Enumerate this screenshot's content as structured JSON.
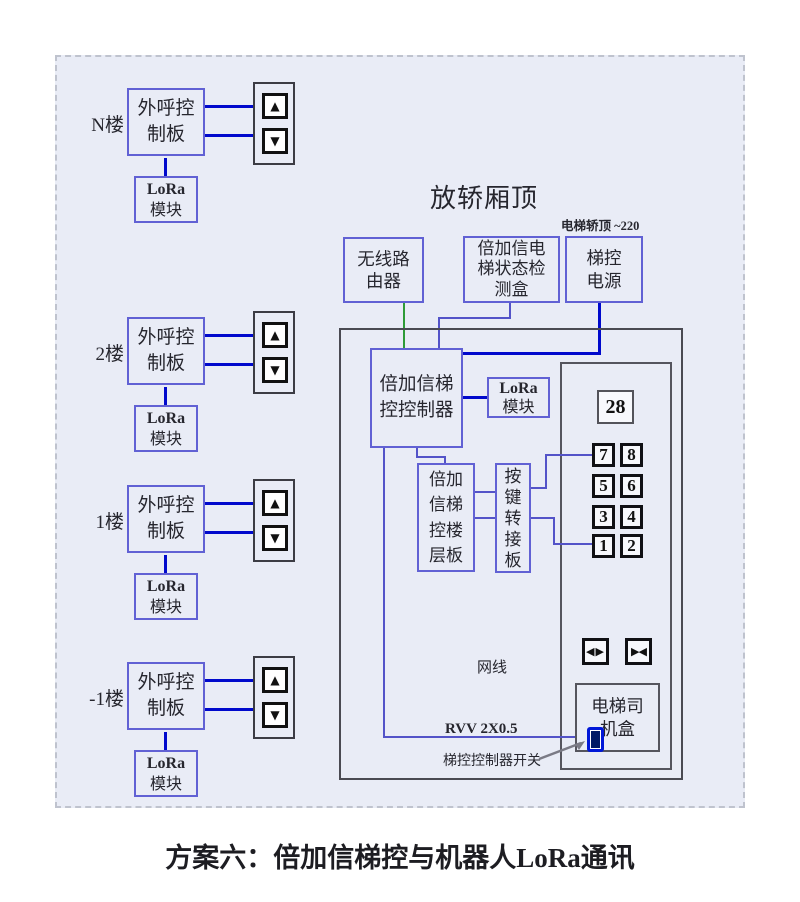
{
  "caption": "方案六：倍加信梯控与机器人LoRa通讯",
  "colors": {
    "panel_bg": "#e9ecf6",
    "wire_blue": "#0009cc",
    "wire_purple": "#5353c8",
    "wire_green": "#2e9b38",
    "box_border": "#6161d4",
    "switch_blue": "#0017d8"
  },
  "icons": {
    "up": "▲",
    "down": "▼",
    "door_open": "◀▶",
    "door_close": "▶◀"
  },
  "floors": [
    {
      "label": "N楼",
      "board_l1": "外呼控",
      "board_l2": "制板",
      "lora_l1": "LoRa",
      "lora_l2": "模块"
    },
    {
      "label": "2楼",
      "board_l1": "外呼控",
      "board_l2": "制板",
      "lora_l1": "LoRa",
      "lora_l2": "模块"
    },
    {
      "label": "1楼",
      "board_l1": "外呼控",
      "board_l2": "制板",
      "lora_l1": "LoRa",
      "lora_l2": "模块"
    },
    {
      "label": "-1楼",
      "board_l1": "外呼控",
      "board_l2": "制板",
      "lora_l1": "LoRa",
      "lora_l2": "模块"
    }
  ],
  "cartop": {
    "title": "放轿厢顶",
    "power_note": "电梯轿顶 ~220",
    "router_l1": "无线路",
    "router_l2": "由器",
    "detector_l1": "倍加信电",
    "detector_l2": "梯状态检",
    "detector_l3": "测盒",
    "power_l1": "梯控",
    "power_l2": "电源",
    "controller_l1": "倍加信梯",
    "controller_l2": "控控制器",
    "lora_l1": "LoRa",
    "lora_l2": "模块",
    "floorboard": [
      "倍加",
      "信梯",
      "控楼",
      "层板"
    ],
    "keyadapter": [
      "按",
      "键",
      "转",
      "接",
      "板"
    ],
    "display": "28",
    "buttons": [
      "7",
      "8",
      "5",
      "6",
      "3",
      "4",
      "1",
      "2"
    ],
    "net_label": "网线",
    "rvv_label": "RVV 2X0.5",
    "switch_label": "梯控控制器开关",
    "driver_l1": "电梯司",
    "driver_l2": "机盒"
  }
}
